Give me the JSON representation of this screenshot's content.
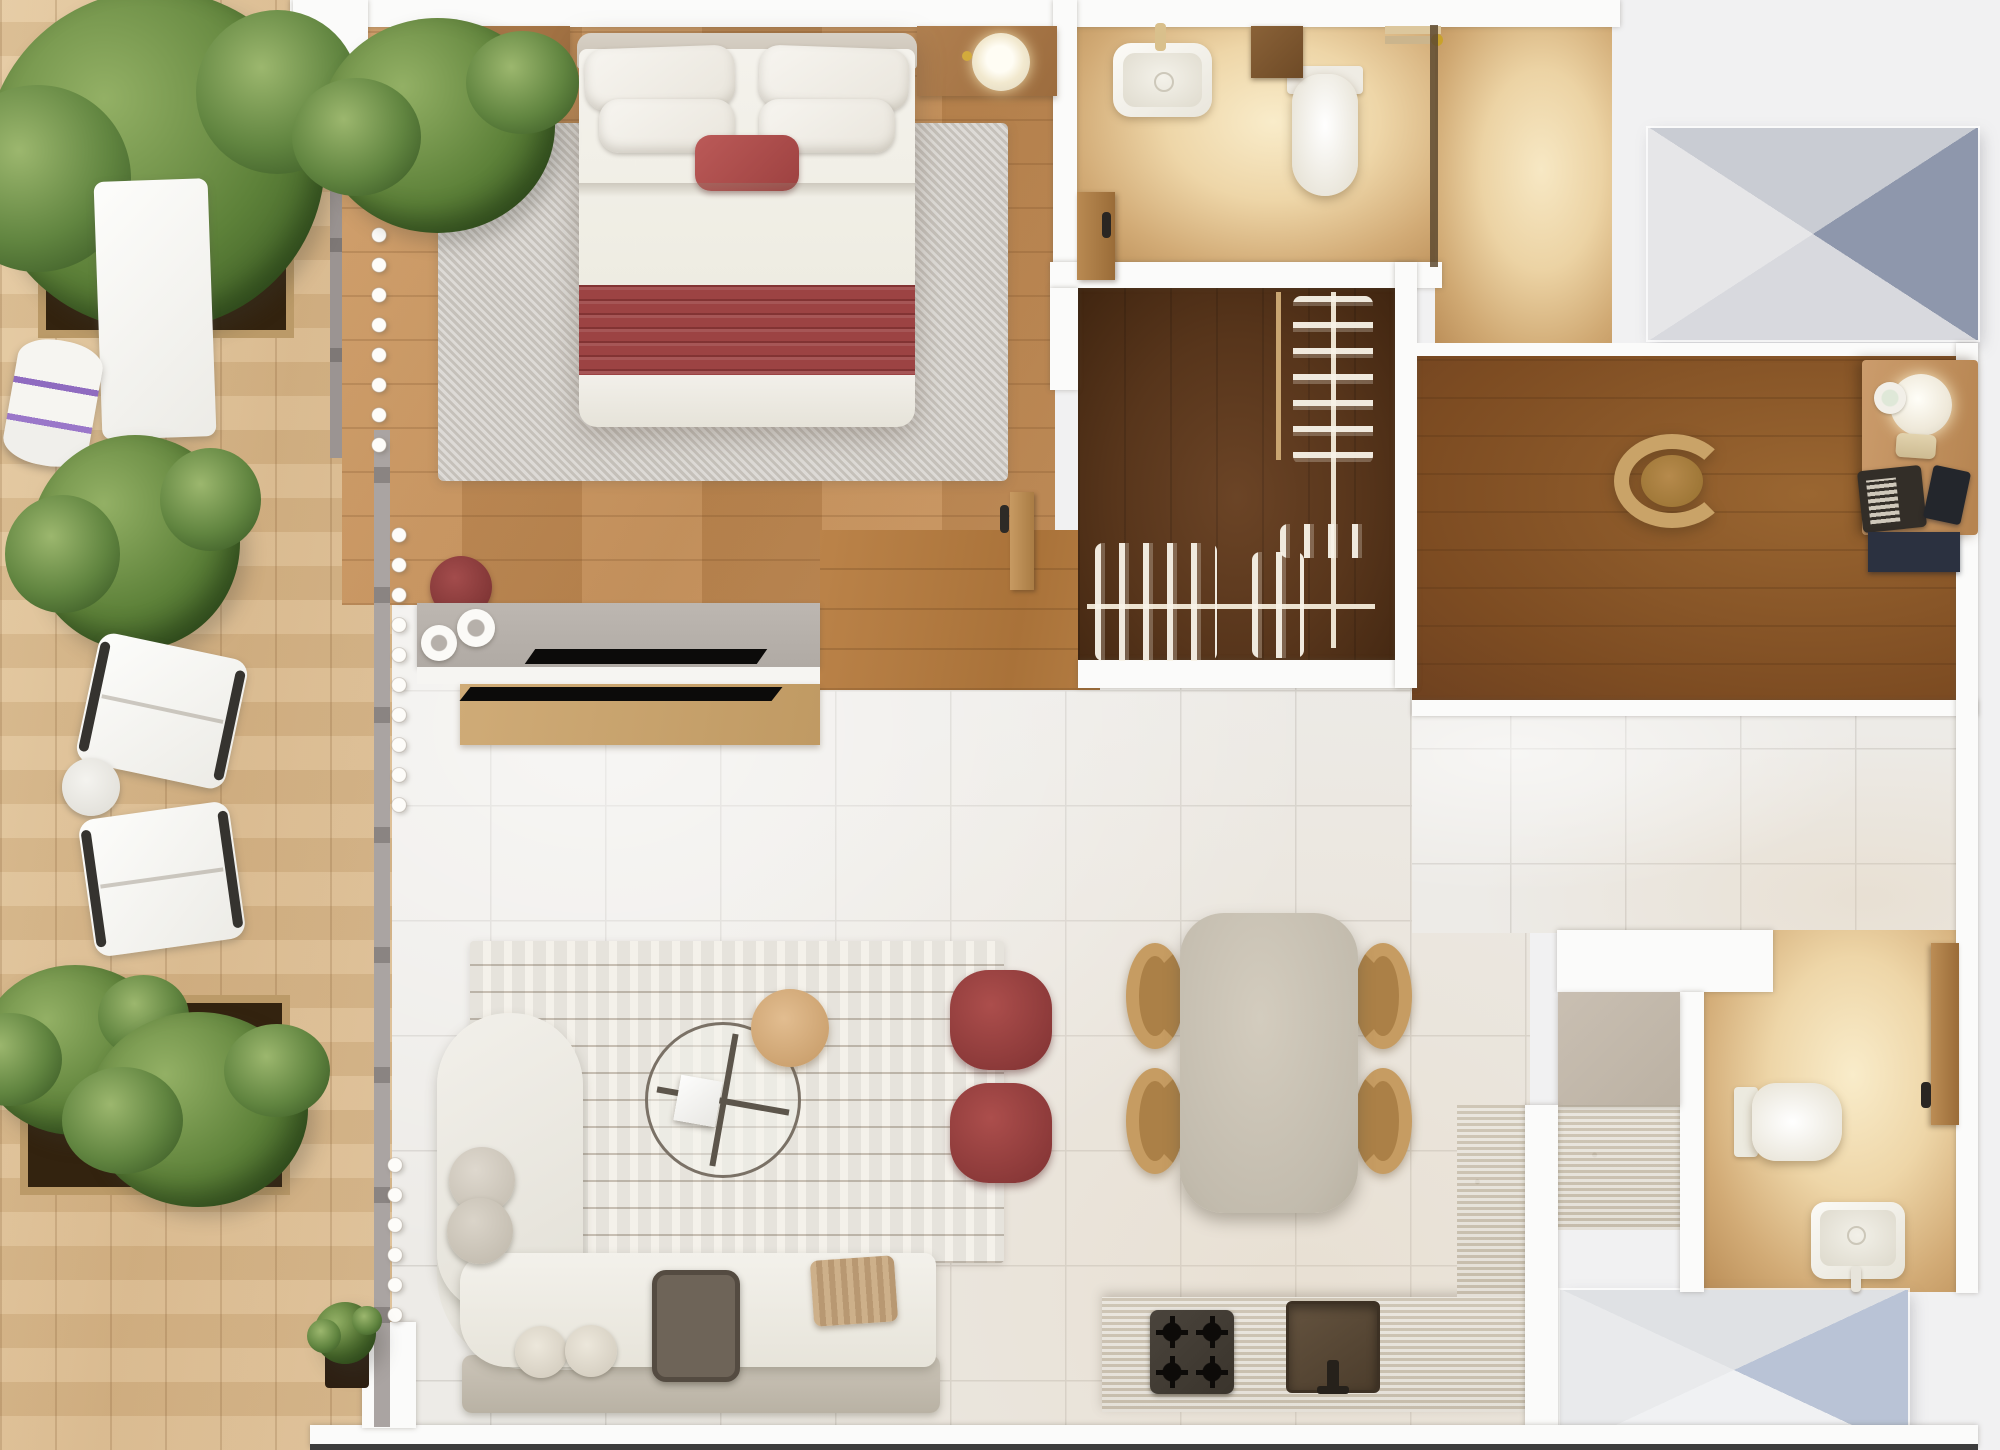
{
  "scene": {
    "type": "apartment-floor-plan-top-down-3d-render",
    "visible_text": "none",
    "orientation": "terrace-left, bedroom-top, bathrooms-top-right-and-bottom-right, open-living-kitchen-center"
  },
  "colors": {
    "bg": "#f1f1f2",
    "wall": "#fbfbfa",
    "terrace": "#ddbf94",
    "oak": "#c5905a",
    "corridor_oak": "#b07a44",
    "closet": "#5a3418",
    "office": "#8a5628",
    "tile": "#edebe7",
    "tile_line": "#d7d4cf",
    "bath_light": "#f8e8c6",
    "bath_deep": "#c09a66",
    "travertine": "#d7d0c2",
    "sofa": "#efede7",
    "greige": "#c6bfb2",
    "rug_cream": "#f4f1ea",
    "rug_gray": "#cecac4",
    "accent_red": "#9c4343",
    "chair_tan": "#c69c62",
    "table_stone": "#c8c1b3",
    "wood_desk": "#c49366",
    "dark_tray": "#6e6458",
    "navy": "#2b3140",
    "env_top": "#c9ccd3",
    "env_right": "#8e97ac",
    "env_bottom": "#d8d9de",
    "env_left": "#e6e6e8",
    "envb_top": "#dfe1e4",
    "envb_right": "#b9c3d6",
    "envb_bottom": "#f0f1f3",
    "envb_left": "#e9eaec"
  },
  "rooms": [
    {
      "id": "terrace",
      "floor": "light-oak-decking",
      "items": [
        "hedge-planter-top",
        "hedge-mid",
        "hedge-planter-bottom",
        "lounge-mat",
        "rolled-towel",
        "lounge-chair-1",
        "lounge-chair-2",
        "round-side-table",
        "potted-plant-small"
      ]
    },
    {
      "id": "bedroom",
      "floor": "oak-plank",
      "items": [
        "double-bed",
        "headboard",
        "pillows",
        "red-lumbar-pillow",
        "red-pleated-throw",
        "gray-area-rug",
        "nightstand-left",
        "nightstand-right",
        "round-table-lamp",
        "maroon-ottoman",
        "tv-sideboard",
        "window-curtain"
      ]
    },
    {
      "id": "ensuite-bathroom",
      "floor": "beige-marble",
      "items": [
        "vanity-sink",
        "faucet",
        "toilet",
        "wood-door",
        "storage-cabinet",
        "towels",
        "glass-partition",
        "shower-area"
      ]
    },
    {
      "id": "walk-in-closet",
      "floor": "dark-walnut",
      "items": [
        "vertical-clothes-rail",
        "horizontal-clothes-rail",
        "hanger-clusters"
      ]
    },
    {
      "id": "home-office",
      "floor": "walnut-plank",
      "items": [
        "desk",
        "desk-lamp",
        "trinket-plate",
        "smartphone",
        "laptop",
        "notebook",
        "navy-drawer-unit",
        "task-chair"
      ]
    },
    {
      "id": "living-dining",
      "floor": "porcelain-tile",
      "items": [
        "corner-sofa",
        "chaise-cushions",
        "toss-pillows",
        "tray-table",
        "knit-throw",
        "striped-rug",
        "glass-coffee-table",
        "wood-disc-table",
        "white-book",
        "maroon-pouf-1",
        "maroon-pouf-2",
        "dining-table",
        "dining-chair-tl",
        "dining-chair-tr",
        "dining-chair-bl",
        "dining-chair-br",
        "bedroom-door",
        "corridor"
      ]
    },
    {
      "id": "kitchen",
      "floor": "porcelain-tile",
      "items": [
        "travertine-island",
        "gas-cooktop",
        "kitchen-sink",
        "tall-greige-cabinet",
        "travertine-column"
      ]
    },
    {
      "id": "guest-bathroom",
      "floor": "beige-marble",
      "items": [
        "wall-hung-toilet",
        "basin-sink",
        "wood-door"
      ]
    },
    {
      "id": "roof-elements",
      "items": [
        "gray-skylight-panel-top-right",
        "blue-skylight-panel-bottom-right"
      ]
    }
  ]
}
